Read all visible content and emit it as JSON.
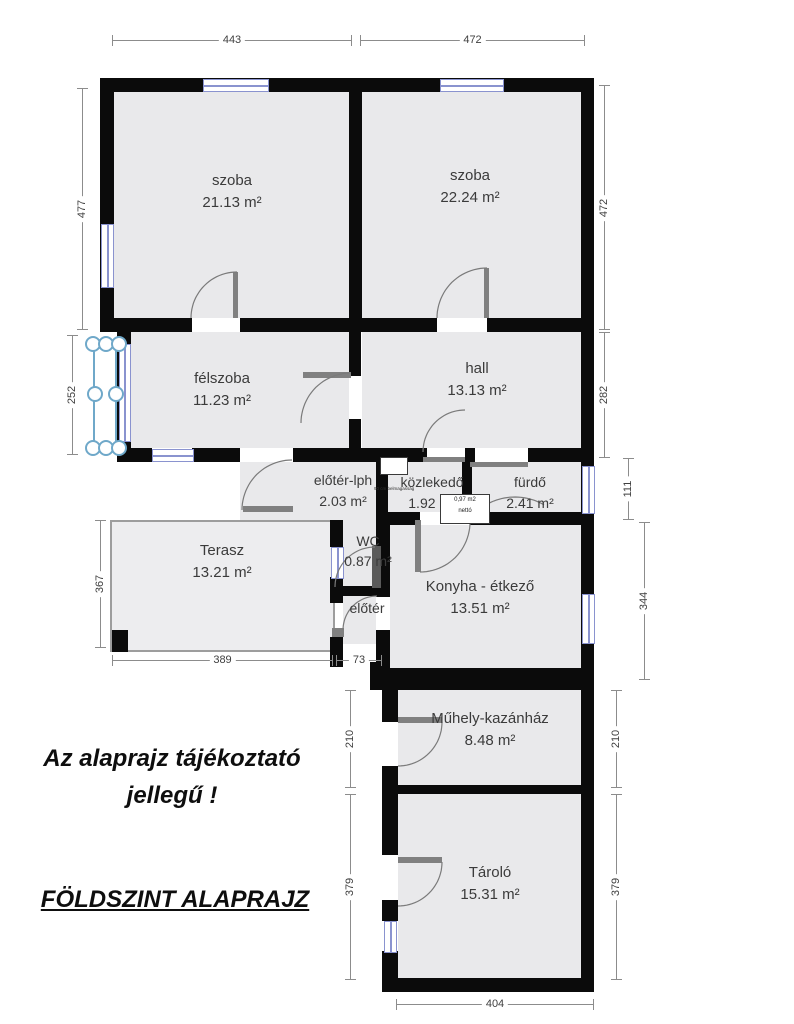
{
  "meta": {
    "plan_note": "Az alaprajz tájékoztató jellegű !",
    "plan_title": "FÖLDSZINT ALAPRAJZ"
  },
  "rooms": [
    {
      "name": "szoba",
      "area": "21.13 m²"
    },
    {
      "name": "szoba",
      "area": "22.24 m²"
    },
    {
      "name": "félszoba",
      "area": "11.23 m²"
    },
    {
      "name": "hall",
      "area": "13.13 m²"
    },
    {
      "name": "előtér-lph",
      "area": "2.03 m²"
    },
    {
      "name": "közlekedő",
      "area": "1.92 m²"
    },
    {
      "name": "fürdő",
      "area": "2.41 m²"
    },
    {
      "name": "Terasz",
      "area": "13.21 m²"
    },
    {
      "name": "WC",
      "area": "0.87 m²"
    },
    {
      "name": "előtér",
      "area": ""
    },
    {
      "name": "Konyha - étkező",
      "area": "13.51 m²"
    },
    {
      "name": "Műhely-kazánház",
      "area": "8.48 m²"
    },
    {
      "name": "Tároló",
      "area": "15.31 m²"
    }
  ],
  "dimensions": {
    "top_left": "443",
    "top_right": "472",
    "left_upper": "477",
    "left_bay": "252",
    "left_terrace": "367",
    "right_upper": "472",
    "right_hall": "282",
    "right_bath": "111",
    "right_kitchen": "344",
    "workshop_left": "210",
    "workshop_right": "210",
    "storage_left": "379",
    "storage_right": "379",
    "bottom_terrace": "389",
    "bottom_passage": "73",
    "bottom_storage": "404"
  },
  "annotations": {
    "net_area_line1": "0,97 m2",
    "net_area_line2": "nettó",
    "height_note": "90 cm belmagasság"
  },
  "colors": {
    "wall": "#0b0b0b",
    "room_fill": "#e9e9eb",
    "window_frame": "#8a93cf",
    "dim_line": "#8c8c8c"
  }
}
